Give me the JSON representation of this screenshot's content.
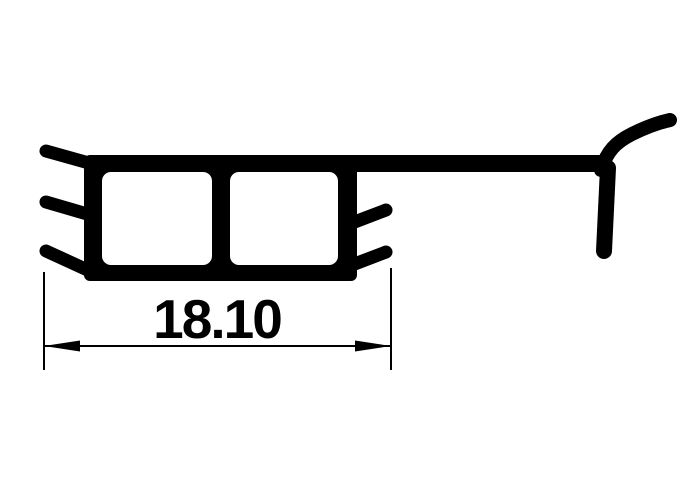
{
  "drawing": {
    "type": "technical-profile-cross-section",
    "dimension": {
      "label": "18.10"
    },
    "colors": {
      "ink": "#000000",
      "background": "#ffffff"
    }
  }
}
